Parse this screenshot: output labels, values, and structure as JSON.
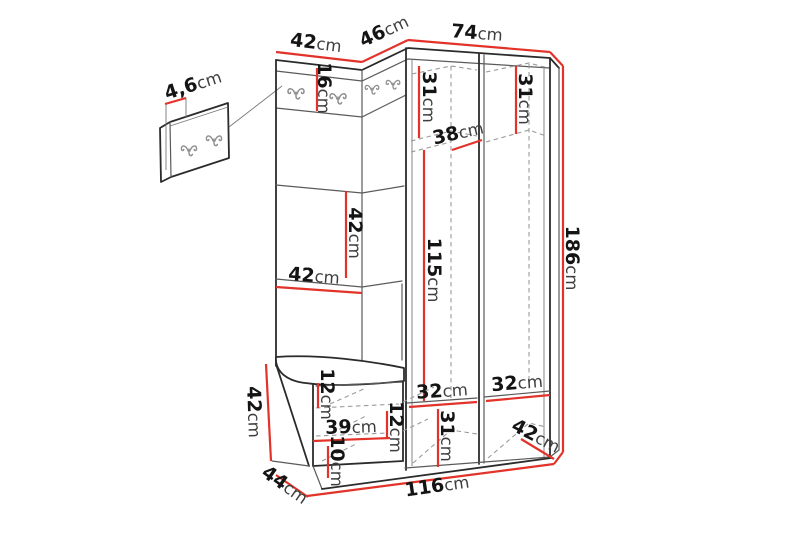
{
  "page": {
    "background": "#ffffff",
    "description": "Dimension drawing of a hallway furniture set: wall hook panel, corner coat rack with bench and two-door wardrobe"
  },
  "diagram": {
    "unit": "cm",
    "icons": {
      "hook": "double-coat-hook-icon"
    },
    "colors": {
      "page_bg": "#ffffff",
      "outline": "#2b2b2b",
      "outline_light": "#5a5a5a",
      "guide": "#777777",
      "hidden_line": "#9a9a9a",
      "dimension_line": "#e2332a",
      "hook": "#8f8f8f",
      "label_number": "#141414",
      "label_unit": "#3e3e3e"
    },
    "dims": {
      "topLeft": {
        "value": "42",
        "unit": "cm"
      },
      "topCorner": {
        "value": "46",
        "unit": "cm"
      },
      "topRight": {
        "value": "74",
        "unit": "cm"
      },
      "panelThickness": {
        "value": "4,6",
        "unit": "cm"
      },
      "stripHeight": {
        "value": "16",
        "unit": "cm"
      },
      "upperLeft": {
        "value": "31",
        "unit": "cm"
      },
      "upperRight": {
        "value": "31",
        "unit": "cm"
      },
      "shelfDepth": {
        "value": "38",
        "unit": "cm"
      },
      "midHeight": {
        "value": "42",
        "unit": "cm"
      },
      "midWidth": {
        "value": "42",
        "unit": "cm"
      },
      "hangingHeight": {
        "value": "115",
        "unit": "cm"
      },
      "totalHeight": {
        "value": "186",
        "unit": "cm"
      },
      "benchHeight": {
        "value": "42",
        "unit": "cm"
      },
      "benchTop": {
        "value": "12",
        "unit": "cm"
      },
      "benchWidth": {
        "value": "39",
        "unit": "cm"
      },
      "benchRight": {
        "value": "12",
        "unit": "cm"
      },
      "plinth": {
        "value": "10",
        "unit": "cm"
      },
      "benchDepth": {
        "value": "44",
        "unit": "cm"
      },
      "botLeft": {
        "value": "32",
        "unit": "cm"
      },
      "botRight": {
        "value": "32",
        "unit": "cm"
      },
      "botHeight": {
        "value": "31",
        "unit": "cm"
      },
      "wardrobeDepth": {
        "value": "42",
        "unit": "cm"
      },
      "totalWidth": {
        "value": "116",
        "unit": "cm"
      }
    }
  }
}
